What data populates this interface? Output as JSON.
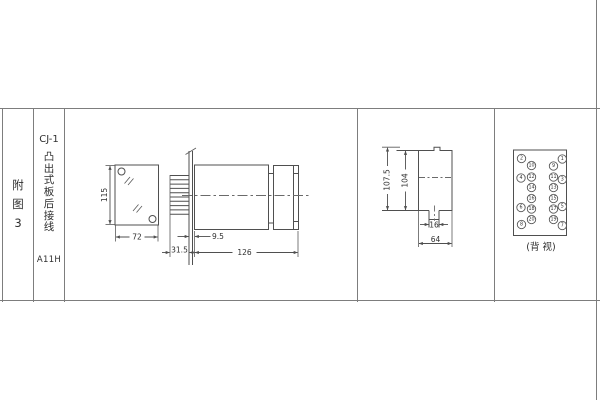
{
  "title_block": {
    "figure_label": "附\n图\n3",
    "model": "CJ-1",
    "mounting_type": "凸\n出\n式\n板\n后\n接\n线",
    "code": "A11H"
  },
  "front_view": {
    "height": "115",
    "width": "72"
  },
  "side_view": {
    "pin_length": "31.5",
    "panel_offset": "9.5",
    "total_length": "126"
  },
  "cutout_view": {
    "total_height": "107.5",
    "hole_height": "104",
    "notch_width": "16",
    "hole_width": "64"
  },
  "back_view": {
    "caption": "(背 视)",
    "terminals": [
      {
        "n": "1",
        "x": 562.3,
        "y": 159
      },
      {
        "n": "2",
        "x": 521.5,
        "y": 158.5
      },
      {
        "n": "3",
        "x": 562.3,
        "y": 179.5
      },
      {
        "n": "4",
        "x": 521,
        "y": 178
      },
      {
        "n": "5",
        "x": 562.3,
        "y": 206.5
      },
      {
        "n": "6",
        "x": 521,
        "y": 207.5
      },
      {
        "n": "7",
        "x": 562.3,
        "y": 225.5
      },
      {
        "n": "8",
        "x": 521.5,
        "y": 224.5
      },
      {
        "n": "9",
        "x": 553.5,
        "y": 166
      },
      {
        "n": "10",
        "x": 531.5,
        "y": 165.5
      },
      {
        "n": "11",
        "x": 553.5,
        "y": 177
      },
      {
        "n": "12",
        "x": 531.5,
        "y": 177
      },
      {
        "n": "13",
        "x": 553.5,
        "y": 187.5
      },
      {
        "n": "14",
        "x": 531.5,
        "y": 187.5
      },
      {
        "n": "15",
        "x": 553.5,
        "y": 198.5
      },
      {
        "n": "16",
        "x": 531.5,
        "y": 198.5
      },
      {
        "n": "17",
        "x": 553.5,
        "y": 209
      },
      {
        "n": "18",
        "x": 531.5,
        "y": 209
      },
      {
        "n": "19",
        "x": 553.5,
        "y": 219.5
      },
      {
        "n": "20",
        "x": 531.5,
        "y": 219.5
      }
    ]
  },
  "colors": {
    "line": "#4f4f4f",
    "table_line": "#7d7d7d",
    "text": "#2f2f2f",
    "background": "#ffffff"
  }
}
